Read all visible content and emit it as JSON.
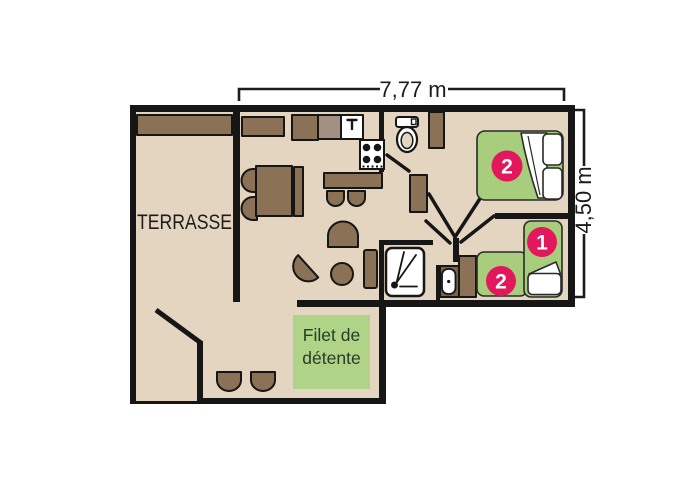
{
  "title": "Mobile-home floor plan with terrace",
  "dimensions": {
    "width": "7,77 m",
    "depth": "4,50 m"
  },
  "rooms": {
    "terrace_label": "TERRASSE",
    "net_area": {
      "line1": "Filet de",
      "line2": "détente"
    }
  },
  "beds": {
    "double_bed_badge": "2",
    "single_bed_right_badge": "1",
    "single_bed_bottom_badge": "2"
  },
  "icons": [
    "shower-icon",
    "toilet-icon",
    "washbasin-icon",
    "stove-burners-icon",
    "sink-faucet-icon"
  ],
  "colors": {
    "floor": "#e4d5c0",
    "wall": "#161616",
    "furniture": "#8b7155",
    "furniture_dark": "#7b6347",
    "appliance_grey": "#a29182",
    "bed_green": "#a7cd7d",
    "net_green": "#afd488",
    "badge_pink": "#e3185c",
    "text_dark": "#1c1c1c",
    "net_text": "#2c3a26"
  }
}
